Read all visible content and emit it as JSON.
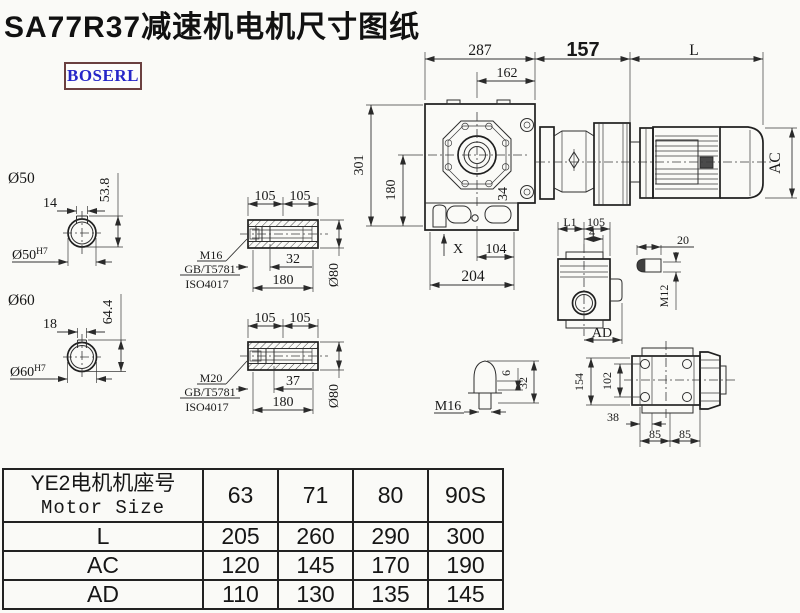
{
  "title": "SA77R37减速机电机尺寸图纸",
  "logo_text": "BOSERL",
  "colors": {
    "line": "#2e2e2e",
    "logo_text": "#2626c8",
    "logo_border": "#6b4040",
    "background": "#fafaf7"
  },
  "main_view": {
    "d287": "287",
    "d162": "162",
    "d157": "157",
    "dL": "L",
    "dAC": "AC",
    "d301": "301",
    "d180": "180",
    "d34": "34",
    "dX": "X",
    "d104": "104",
    "d204": "204"
  },
  "shaft50": {
    "label": "Ø50",
    "key_width": "14",
    "depth": "53.8",
    "bore": "Ø50",
    "bore_tol": "H7"
  },
  "shaft60": {
    "label": "Ø60",
    "key_width": "18",
    "depth": "64.4",
    "bore": "Ø60",
    "bore_tol": "H7"
  },
  "bush1": {
    "d105a": "105",
    "d105b": "105",
    "socket": "32",
    "length": "180",
    "dia": "Ø80",
    "thread": "M16",
    "std1": "GB/T5781",
    "std2": "ISO4017"
  },
  "bush2": {
    "d105a": "105",
    "d105b": "105",
    "socket": "37",
    "length": "180",
    "dia": "Ø80",
    "thread": "M20",
    "std1": "GB/T5781",
    "std2": "ISO4017"
  },
  "side_view": {
    "dL1": "L1",
    "d105": "105",
    "d4": "4",
    "dAD": "AD"
  },
  "key_detail": {
    "d20": "20",
    "thread": "M12"
  },
  "plug_detail": {
    "d6": "6",
    "d32": "32",
    "thread": "M16"
  },
  "back_view": {
    "d154": "154",
    "d102": "102",
    "d38": "38",
    "d85a": "85",
    "d85b": "85"
  },
  "table": {
    "header_cn": "YE2电机机座号",
    "header_en": "Motor Size",
    "columns": [
      "63",
      "71",
      "80",
      "90S"
    ],
    "rows": [
      {
        "label": "L",
        "values": [
          "205",
          "260",
          "290",
          "300"
        ]
      },
      {
        "label": "AC",
        "values": [
          "120",
          "145",
          "170",
          "190"
        ]
      },
      {
        "label": "AD",
        "values": [
          "110",
          "130",
          "135",
          "145"
        ]
      }
    ]
  }
}
